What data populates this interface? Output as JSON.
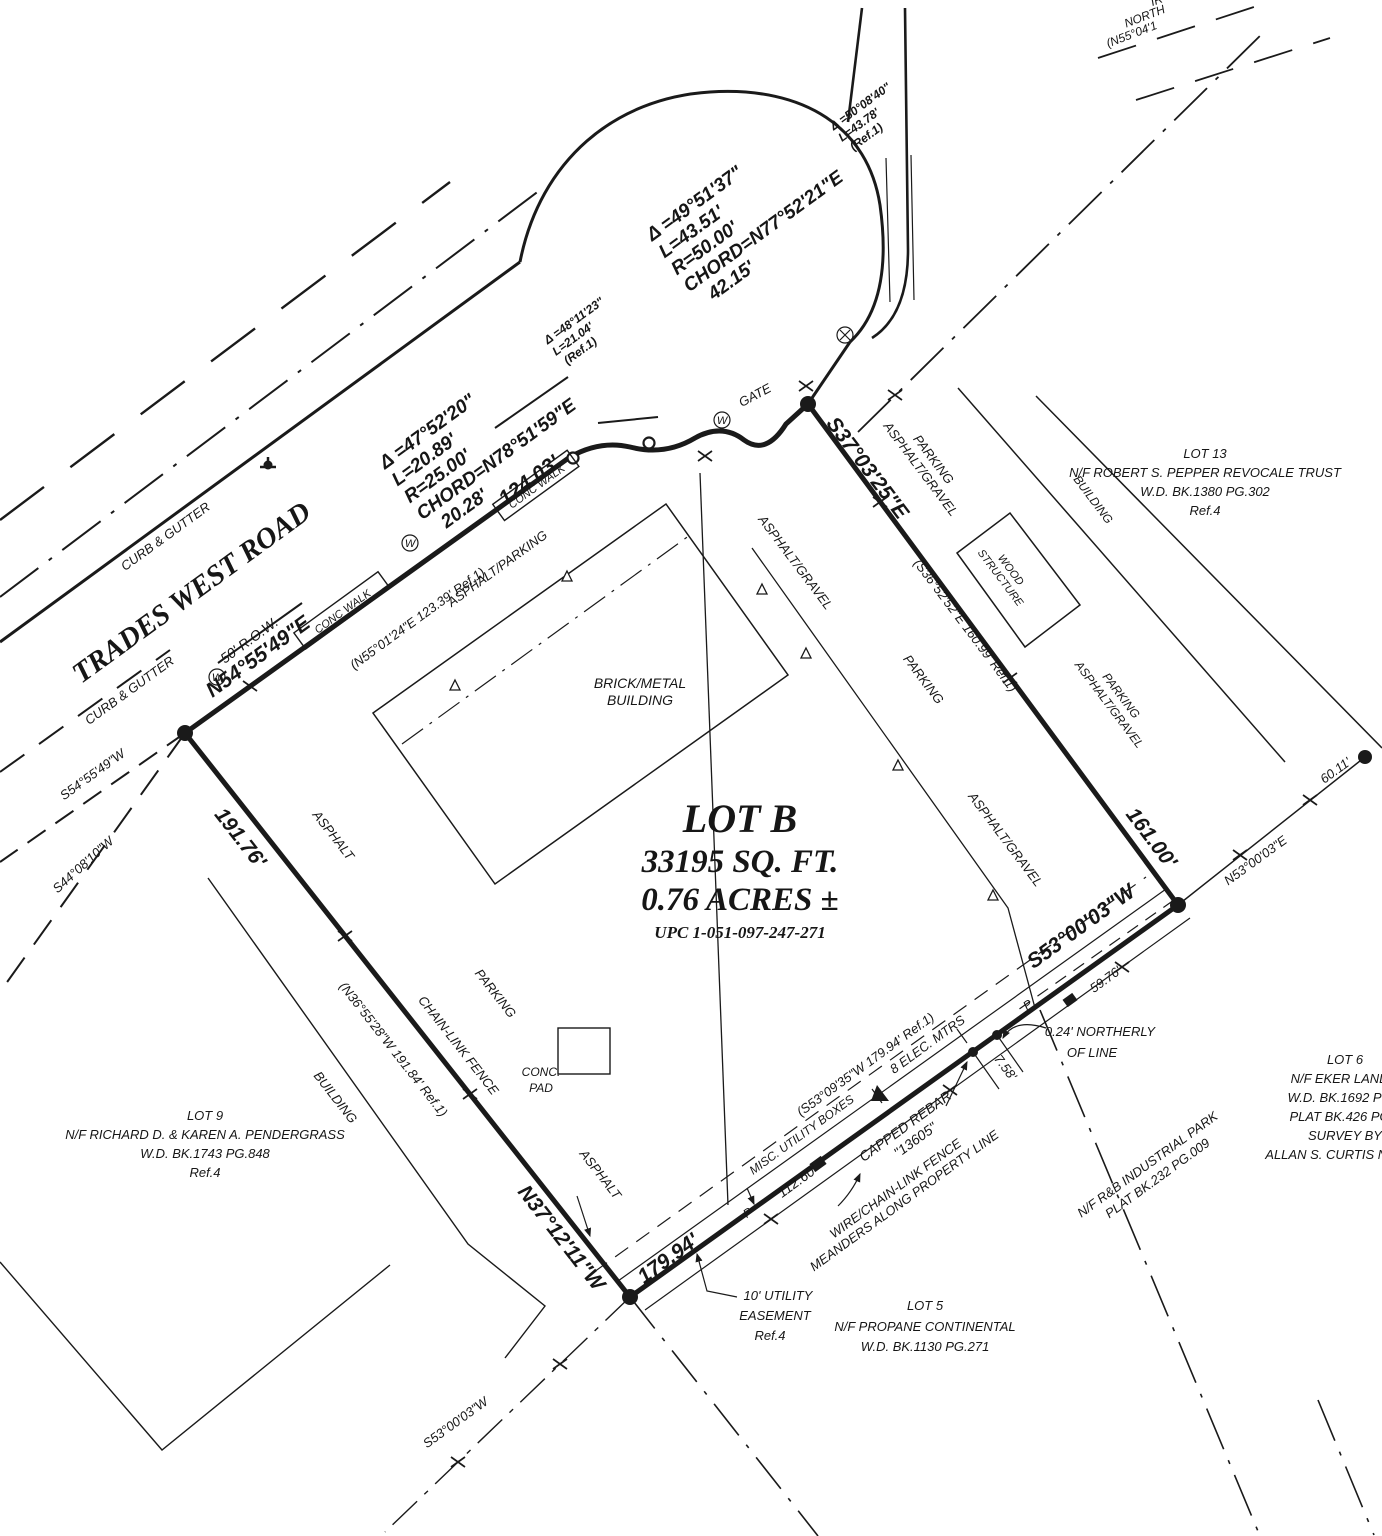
{
  "colors": {
    "ink": "#1a1a1a",
    "paper": "#ffffff"
  },
  "road": {
    "name": "TRADES WEST ROAD",
    "row": "50' R.O.W.",
    "curb_upper": "CURB & GUTTER",
    "curb_lower": "CURB & GUTTER",
    "walk1": "CONC WALK",
    "walk2": "CONC WALK",
    "gate": "GATE",
    "offsite1": "IR",
    "offsite2": "NORTH",
    "offsite3": "(N55°04'1"
  },
  "curves": {
    "c1": {
      "delta": "Δ =47°52'20\"",
      "len": "L=20.89'",
      "radius": "R=25.00'",
      "chord": "CHORD=N78°51'59\"E",
      "chord_len": "20.28'"
    },
    "c2": {
      "delta": "Δ =48°11'23\"",
      "len": "L=21.04'",
      "ref": "(Ref.1)"
    },
    "c3": {
      "delta": "Δ =49°51'37\"",
      "len": "L=43.51'",
      "radius": "R=50.00'",
      "chord": "CHORD=N77°52'21\"E",
      "chord_len": "42.15'"
    },
    "c4": {
      "delta": "Δ =50°08'40\"",
      "len": "L=43.78'",
      "ref": "(Ref.1)"
    }
  },
  "boundary": {
    "front_bearing": "N54°55'49\"E",
    "front_dist": "124.03'",
    "front_ref": "(N55°01'24\"E  123.39'  Ref.1)",
    "east_bearing": "S37°03'25\"E",
    "east_dist": "161.00'",
    "east_ref": "(S36°52'52\"E  160.99'  Ref.1)",
    "se_bearing": "S53°00'03\"W",
    "se_dist": "179.94'",
    "se_ref": "(S53°09'35\"W  179.94'  Ref.1)",
    "se_d1": "112.60'",
    "se_d2": "7.58'",
    "se_d3": "59.76'",
    "west_bearing": "N37°12'11\"W",
    "west_dist": "191.76'",
    "west_ref": "(N36°55'28\"W  191.84'  Ref.1)",
    "ext_s54": "S54°55'49\"W",
    "ext_s44": "S44°08'10\"W",
    "ne_bearing": "N53°00'03\"E",
    "ne_dist": "60.11'",
    "sw_fence_bearing": "S53°00'03\"W"
  },
  "lot_b": {
    "name": "LOT B",
    "area_sqft": "33195 SQ. FT.",
    "area_acres": "0.76 ACRES ±",
    "upc": "UPC  1-051-097-247-271",
    "building_l1": "BRICK/METAL",
    "building_l2": "BUILDING",
    "pad_l1": "CONC.",
    "pad_l2": "PAD"
  },
  "surfaces": {
    "asphalt_parking": "ASPHALT/PARKING",
    "asphalt_west": "ASPHALT",
    "parking_west": "PARKING",
    "asphalt_south": "ASPHALT",
    "chain_link": "CHAIN-LINK FENCE",
    "ag_mid": "ASPHALT/GRAVEL",
    "parking_mid": "PARKING",
    "ag_low": "ASPHALT/GRAVEL",
    "ne_parking": "PARKING",
    "ne_ag": "ASPHALT/GRAVEL",
    "l13_parking": "PARKING",
    "l13_ag": "ASPHALT/GRAVEL",
    "l13_building": "BUILDING",
    "wood_l1": "WOOD",
    "wood_l2": "STRUCTURE",
    "l9_building": "BUILDING"
  },
  "annotations": {
    "misc_boxes": "MISC. UTILITY BOXES",
    "elec": "8 ELEC. MTRS",
    "rebar_l1": "CAPPED REBAR",
    "rebar_l2": "\"13605\"",
    "wire_l1": "WIRE/CHAIN-LINK FENCE",
    "wire_l2": "MEANDERS ALONG PROPERTY LINE",
    "northerly_l1": "0.24' NORTHERLY",
    "northerly_l2": "OF LINE",
    "ease_l1": "10' UTILITY",
    "ease_l2": "EASEMENT",
    "ease_l3": "Ref.4",
    "p_mark1": "P",
    "p_mark2": "P",
    "water_meter": "W"
  },
  "adjoiners": {
    "lot13": [
      "LOT 13",
      "N/F ROBERT S. PEPPER REVOCALE TRUST",
      "W.D. BK.1380 PG.302",
      "Ref.4"
    ],
    "lot9": [
      "LOT 9",
      "N/F RICHARD D. & KAREN A. PENDERGRASS",
      "W.D. BK.1743 PG.848",
      "Ref.4"
    ],
    "lot5": [
      "LOT 5",
      "N/F PROPANE CONTINENTAL",
      "W.D. BK.1130 PG.271"
    ],
    "lot6": [
      "LOT 6",
      "N/F EKER LAND L",
      "W.D. BK.1692 PG.8",
      "PLAT BK.426 PG.0",
      "SURVEY BY",
      "ALLAN S. CURTIS N.M.L.S"
    ],
    "rb": [
      "N/F R&B INDUSTRIAL PARK",
      "PLAT BK.232 PG.009"
    ]
  }
}
